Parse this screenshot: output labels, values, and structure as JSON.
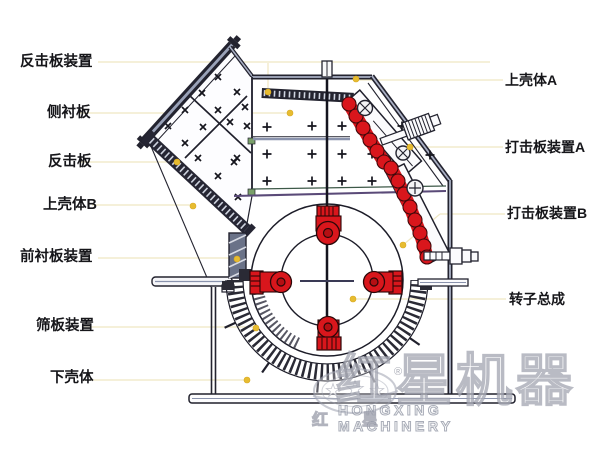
{
  "diagram": {
    "labels_left": [
      {
        "id": "impact-plate-assembly",
        "text": "反击板装置"
      },
      {
        "id": "side-liner-plate",
        "text": "侧衬板"
      },
      {
        "id": "impact-plate",
        "text": "反击板"
      },
      {
        "id": "upper-casing-b",
        "text": "上壳体B"
      },
      {
        "id": "front-liner-assembly",
        "text": "前衬板装置"
      },
      {
        "id": "sieve-plate-assembly",
        "text": "筛板装置"
      },
      {
        "id": "lower-casing",
        "text": "下壳体"
      }
    ],
    "labels_right": [
      {
        "id": "upper-casing-a",
        "text": "上壳体A"
      },
      {
        "id": "blow-bar-assembly-a",
        "text": "打击板装置A"
      },
      {
        "id": "blow-bar-assembly-b",
        "text": "打击板装置B"
      },
      {
        "id": "rotor-assembly",
        "text": "转子总成"
      }
    ]
  },
  "watermark": {
    "brand_cn": "红星机器",
    "brand_en": "HONGXING MACHINERY",
    "logo_char_left": "红",
    "logo_char_right": "星",
    "registered_mark": "®"
  },
  "colors": {
    "part_red": "#d9161c",
    "leader_line": "#efe7c2",
    "leader_dot": "#e7bc30",
    "line_dark": "#1c1c28",
    "line_blue": "#9aa2b8"
  }
}
